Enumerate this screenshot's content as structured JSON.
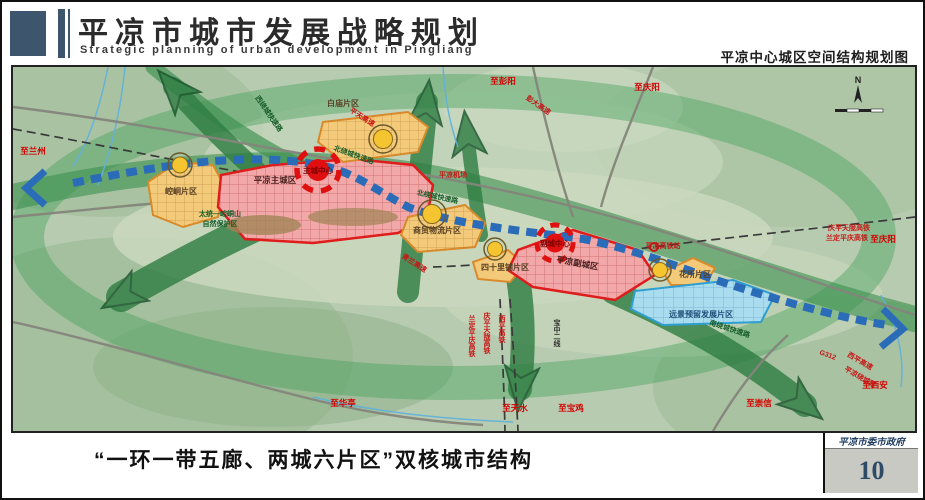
{
  "header": {
    "title": "平凉市城市发展战略规划",
    "subtitle": "Strategic planning of urban development in Pingliang",
    "map_title": "平凉中心城区空间结构规划图"
  },
  "footer": {
    "caption": "“一环一带五廊、两城六片区”双核城市结构",
    "agency": "平凉市委市政府",
    "page_number": "10"
  },
  "map": {
    "compass_n": "N",
    "zone_labels": {
      "kongtong": "崆峒片区",
      "main_city": "平凉主城区",
      "main_center": "主城中心",
      "baimiao": "白庙片区",
      "logistics": "商贸物流片区",
      "sishilipu": "四十里铺片区",
      "sub_city": "平凉副城区",
      "sub_center": "副城中心",
      "huasuo": "花所片区",
      "reserved": "远景预留发展片区"
    },
    "road_labels": {
      "west_ring": "西绕城快速路",
      "north_ring_a": "北绕城快速路",
      "north_ring_b": "北绕城快速路",
      "south_ring": "南绕城快速路",
      "pingtian": "平天高速",
      "pengda": "彭大高速",
      "qinglan": "青兰高速",
      "g312": "G312",
      "xiping": "西平高速",
      "raocheng": "平凉绕城路"
    },
    "rail_labels": {
      "hsr_station": "平凉高铁站",
      "qingping_tianlong_r": "庆平天陇高铁",
      "landing_pingqing_r": "兰定平庆高铁",
      "landing_pingqing_s": "兰定平庆高铁",
      "qingping_tianlong_s": "庆平天陇高铁",
      "xiping_hsr": "西平高铁",
      "baozhong": "宝中二线"
    },
    "direction_labels": {
      "to_lanzhou": "至兰州",
      "to_pengyang": "至彭阳",
      "to_qingyang_top": "至庆阳",
      "to_qingyang_right": "至庆阳",
      "to_xian": "至西安",
      "to_chongxin": "至崇信",
      "to_tianshui": "至天水",
      "to_baoji": "至宝鸡",
      "to_huating": "至华亭"
    },
    "poi_labels": {
      "airport": "平凉机场",
      "nature_reserve_1": "太统—崆峒山",
      "nature_reserve_2": "自然保护区"
    },
    "colors": {
      "terrain": "#b7cbb0",
      "corridor_green": "#2e7d42",
      "axis_blue": "#2b6cb8",
      "core_red": "#e01010",
      "zone_orange": "#f3c97a",
      "zone_pink": "#f2a8a8",
      "zone_blue": "#aadcef"
    }
  }
}
